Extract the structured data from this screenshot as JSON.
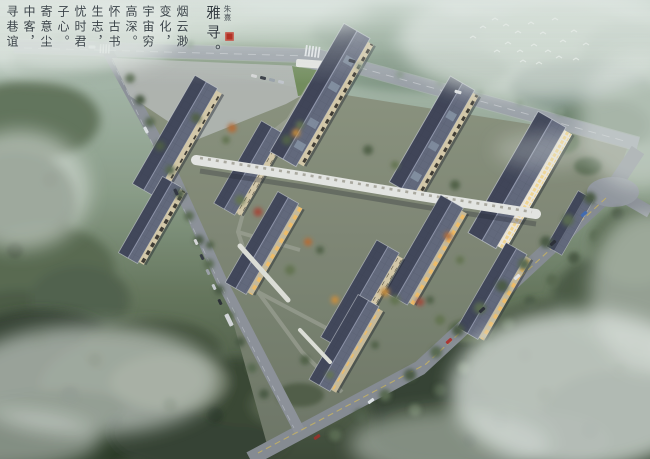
{
  "scene": {
    "type": "architectural-aerial-rendering",
    "description": "Dusk bird's-eye rendering of a Chinese-style campus of long slate-roofed buildings linked by a light corridor, ringed by perimeter roads, misty forest, drifting fog and a flock of white birds",
    "time_of_day": "dusk",
    "birds_count": 20,
    "buildings_count": 12
  },
  "calligraphy": {
    "reading_direction": "right-to-left vertical columns",
    "columns": [
      {
        "text": "寻巷谊"
      },
      {
        "text": "中客，"
      },
      {
        "text": "寄意尘"
      },
      {
        "text": "子心。"
      },
      {
        "text": "忧时君"
      },
      {
        "text": "生志，"
      },
      {
        "text": "怀古书"
      },
      {
        "text": "高深。"
      },
      {
        "text": "宇宙穷"
      },
      {
        "text": "变化，"
      },
      {
        "text": "烟云渺"
      },
      {
        "text": "雅寻。",
        "variant": "title"
      },
      {
        "text": "朱熹",
        "variant": "signature"
      }
    ],
    "seal": "red square artist seal",
    "ink_color": "#3b4349",
    "seal_color": "#b23226"
  },
  "palette": {
    "fog": "#e3eae4",
    "forest_light": "#9fb49f",
    "forest_mid": "#5d7054",
    "forest_dark": "#2f3b2b",
    "road": "#8f949b",
    "road_centerline_yellow": "#c9b35a",
    "roof_dark": "#3a3f52",
    "roof_light": "#5d6377",
    "roof_ridge": "#9aa0b6",
    "facade_cream": "#d6c9a6",
    "window_lit": "#f4bd62",
    "corridor_white": "#e7e8e3",
    "campus_ground": "#7b8371",
    "tree_autumn": "#b5672e",
    "tree_red": "#a04330"
  }
}
